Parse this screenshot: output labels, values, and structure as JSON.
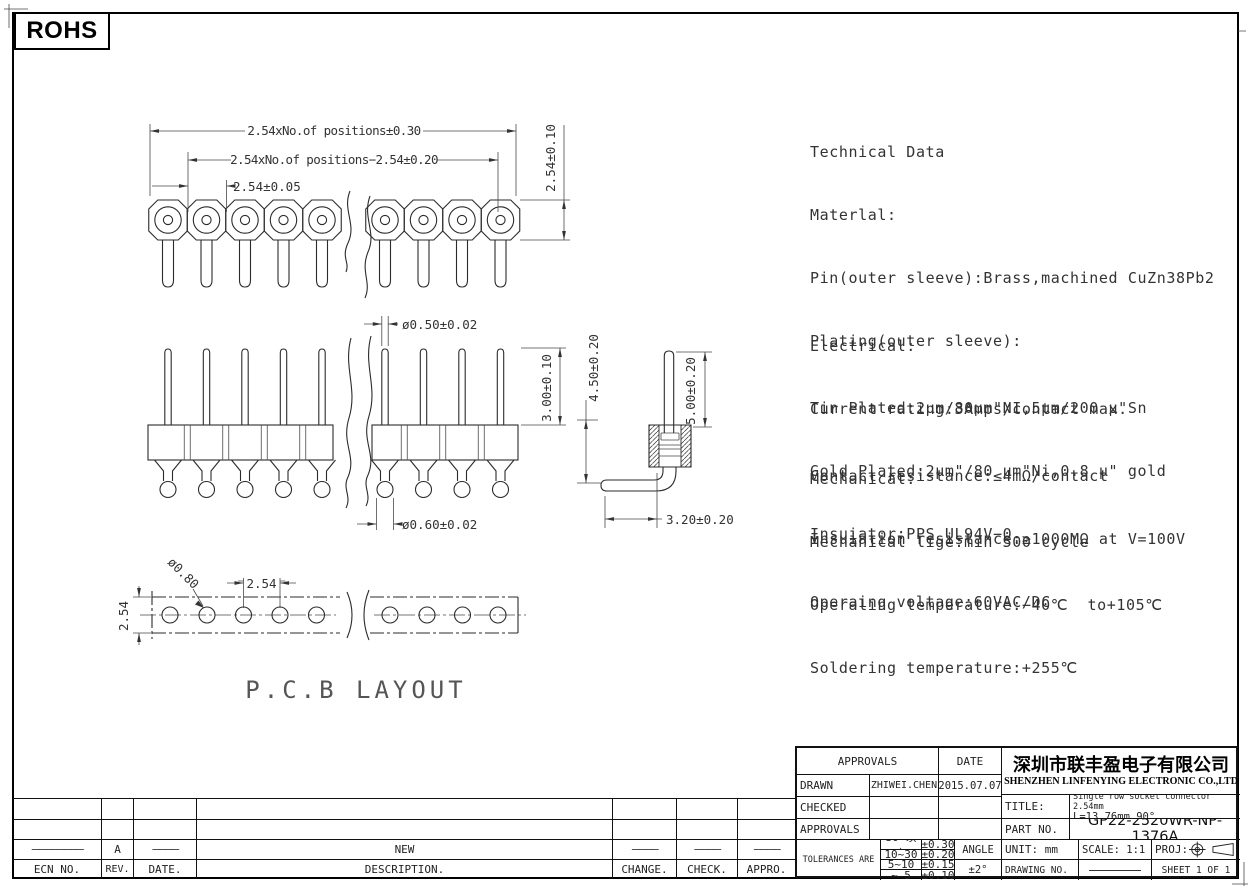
{
  "page": {
    "rohs_label": "ROHS",
    "pcb_caption": "P.C.B LAYOUT"
  },
  "notes": {
    "technical": [
      "Technical Data",
      "Materlal:",
      "Pin(outer sleeve):Brass,machined CuZn38Pb2",
      "Plating(outer sleeve):",
      "Tin Plated:2μm/80μm\"NI,5μm/200 μ\"Sn",
      "Gold Plated:2μm\"/80 μm\"Ni,0.8 μ\" gold",
      "Insuiator:PPS UL94V−0"
    ],
    "electrical": [
      "Electrical:",
      "Current rating:3Amps/contact max.",
      "Contact resistance:≤4mΩ/contact",
      "Insuiation resistance:≥1000MΩ at V=100V",
      "Operaing voltage:60VAC/DC"
    ],
    "mechanical": [
      "Mechanical:",
      "Mechanical lige:min 500 cycle",
      "Operaling temperature:−40℃  to+105℃",
      "Soldering temperature:+255℃"
    ]
  },
  "dims": {
    "top_view": {
      "total": "2.54xNo.of positions±0.30",
      "inner": "2.54xNo.of positions−2.54±0.20",
      "pitch": "2.54±0.05",
      "height": "2.54±0.10"
    },
    "front_view": {
      "pin_dia_top": "ø0.50±0.02",
      "pin_len": "3.00±0.10",
      "overall": "4.50±0.20",
      "tail_len": "5.00±0.20",
      "pin_dia_bottom": "ø0.60±0.02",
      "bend": "3.20±0.20"
    },
    "pcb": {
      "hole_dia": "ø0.80",
      "pitch": "2.54",
      "row": "2.54"
    }
  },
  "title_block": {
    "approvals_header": "APPROVALS",
    "date_header": "DATE",
    "rows": [
      {
        "label": "DRAWN",
        "name": "ZHIWEI.CHEN",
        "date": "2015.07.07"
      },
      {
        "label": "CHECKED",
        "name": "",
        "date": ""
      },
      {
        "label": "APPROVALS",
        "name": "",
        "date": ""
      }
    ],
    "tolerances_label": "TOLERANCES ARE",
    "tolerances": [
      {
        "range": "30~以上",
        "tol": "±0.30"
      },
      {
        "range": "10~30",
        "tol": "±0.20"
      },
      {
        "range": "5~10",
        "tol": "±0.15"
      },
      {
        "range": "~ 5",
        "tol": "±0.10"
      }
    ],
    "angle_label": "ANGLE",
    "angle_tol": "±2°",
    "company_cn": "深圳市联丰盈电子有限公司",
    "company_en": "SHENZHEN LINFENYING ELECTRONIC CO.,LTD",
    "title_label": "TITLE:",
    "title_value_line1": "Single row socket connector 2.54mm",
    "title_value_line2": "L=13.76mm 90°",
    "part_label": "PART NO.",
    "part_value": "GP22-2520WR-NP-1376A",
    "unit": "UNIT: mm",
    "scale": "SCALE: 1:1",
    "proj_label": "PROJ:",
    "drawing_no_label": "DRAWING NO.",
    "sheet": "SHEET 1 OF 1"
  },
  "revision_table": {
    "headers": [
      "ECN NO.",
      "REV.",
      "DATE.",
      "DESCRIPTION.",
      "CHANGE.",
      "CHECK.",
      "APPRO."
    ],
    "entry": {
      "ecn": "————————",
      "rev": "A",
      "date": "————",
      "description": "NEW",
      "change": "————",
      "check": "————",
      "appro": "————"
    }
  }
}
